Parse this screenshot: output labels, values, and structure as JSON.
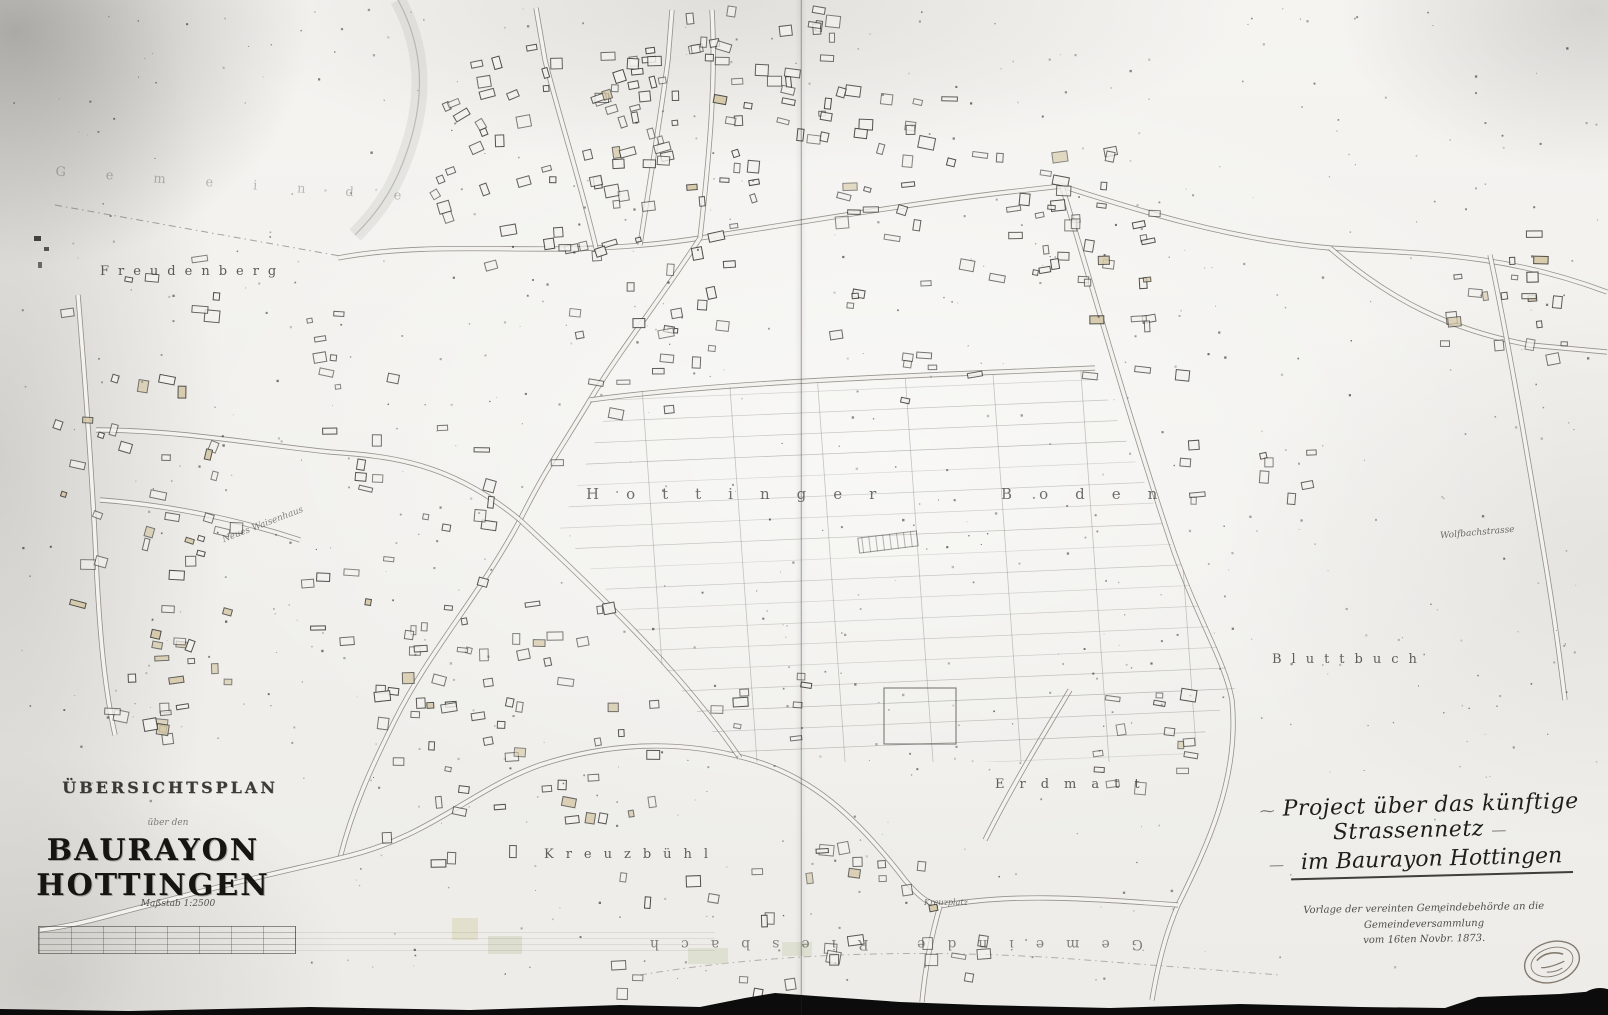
{
  "page": {
    "title": "Übersichtsplan Baurayon Hottingen"
  },
  "title_block": {
    "line1": "ÜBERSICHTSPLAN",
    "line2": "über den",
    "line3": "BAURAYON HOTTINGEN",
    "scale": "Maßstab 1:2500"
  },
  "project_note": {
    "ornament_left": "⁓",
    "title_line1": "Project über das künftige Strassennetz",
    "dash": "—",
    "title_line2": "im Baurayon Hottingen",
    "sub_line1": "Vorlage der vereinten Gemeindebehörde an die Gemeindeversammlung",
    "sub_line2": "vom 16ten Novbr. 1873."
  },
  "place_labels": {
    "freudenberg": "Freudenberg",
    "hottinger_boden": "Hottinger Boden",
    "kreuzbuehl": "Kreuzbühl",
    "erdmatt": "Erdmatt",
    "bluttbuch": "Bluttbuch",
    "kreuzplatz": "Kreuzplatz",
    "gemeinde_top": "Gemeinde",
    "gemeinde_riesbach": "Gemeinde Riesbach",
    "wolfbachstrasse": "Wolfbachstrasse",
    "neues_waisenhaus": "Neues Waisenhaus"
  },
  "colors": {
    "paper": "#f3f2ee",
    "ink": "#3a3934",
    "building_tint": "#d6c9a8",
    "scan_edge": "#0c0c0c"
  }
}
